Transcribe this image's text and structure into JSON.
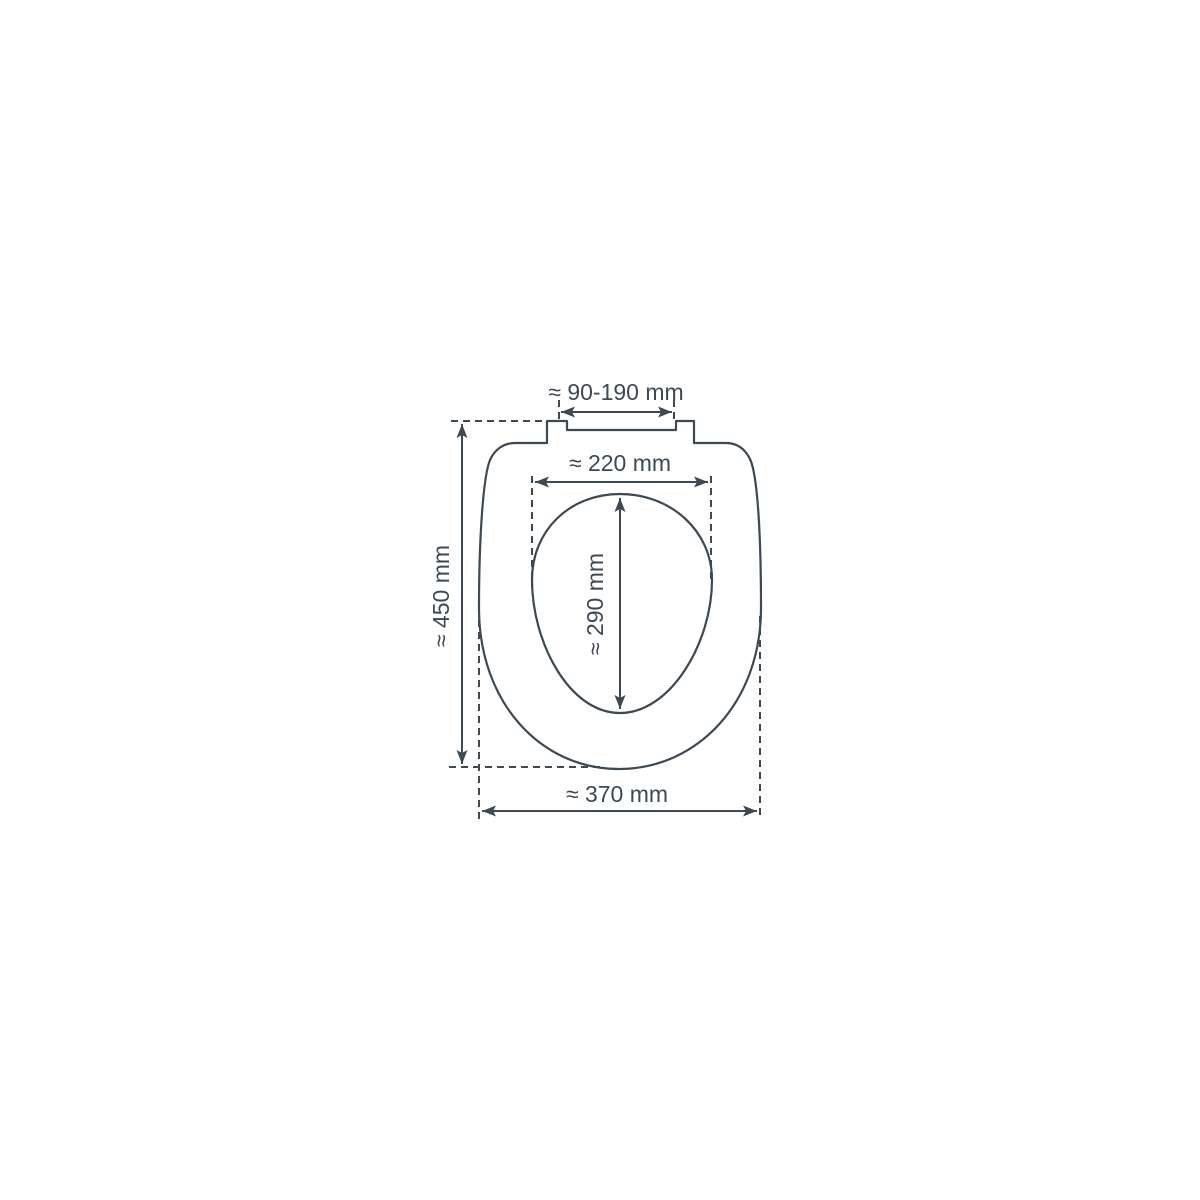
{
  "diagram": {
    "type": "technical-dimension-drawing",
    "subject": "toilet-seat-top-view",
    "labels": {
      "hinge_width": "≈ 90-190 mm",
      "inner_opening_width": "≈ 220 mm",
      "inner_opening_length": "≈ 290 mm",
      "overall_length": "≈ 450 mm",
      "overall_width": "≈ 370 mm"
    },
    "colors": {
      "line": "#3d4953",
      "background": "#ffffff"
    }
  }
}
